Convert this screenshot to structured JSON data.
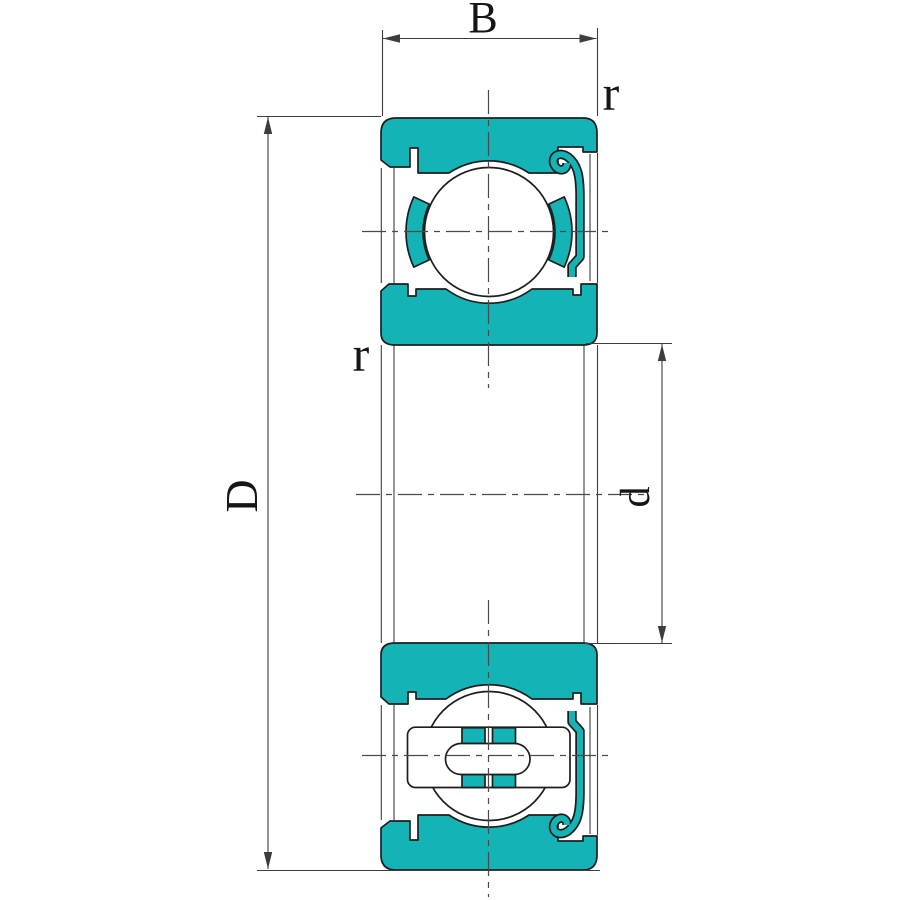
{
  "diagram": {
    "dimension_labels": {
      "width": "B",
      "outer_diameter": "D",
      "bore_diameter": "d",
      "outer_corner_radius": "r",
      "bore_corner_radius": "r"
    },
    "colors": {
      "part_fill": "#14b3b5",
      "outline": "#1e1e1e",
      "thin_line": "#3d3d3d",
      "center_line": "#4a4a4a",
      "background": "#ffffff"
    }
  }
}
